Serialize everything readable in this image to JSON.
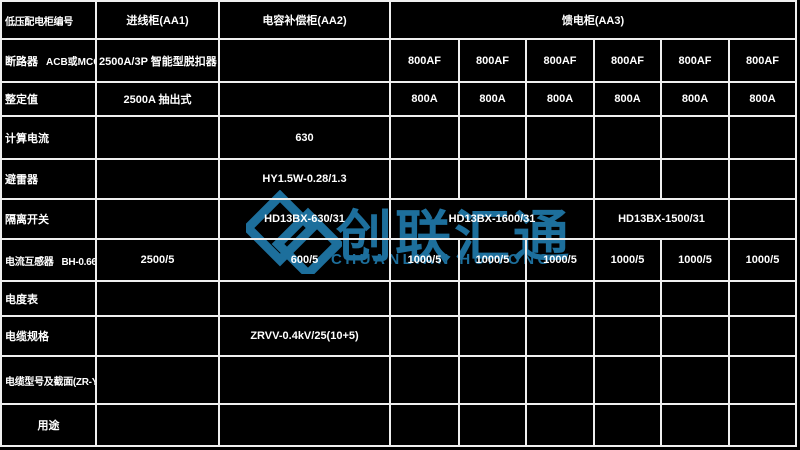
{
  "watermark": {
    "cn_text": "创联汇通",
    "en_text": "CHUANLIAN HUITONG",
    "color": "#1d6f9c"
  },
  "header": {
    "corner": "低压配电柜编号",
    "incoming": "进线柜(AA1)",
    "compensation": "电容补偿柜(AA2)",
    "feeder_section": "馈电柜(AA3)"
  },
  "rows": {
    "breaker": {
      "label": "断路器",
      "sublabel": "ACB或MCCB",
      "incoming": "2500A/3P 智能型脱扣器",
      "feeders": [
        "800AF",
        "800AF",
        "800AF",
        "800AF",
        "800AF",
        "800AF"
      ]
    },
    "setting": {
      "label": "整定值",
      "incoming": "2500A 抽出式",
      "feeders": [
        "800A",
        "800A",
        "800A",
        "800A",
        "800A",
        "800A"
      ]
    },
    "calc_current": {
      "label": "计算电流",
      "compensation": "630"
    },
    "arrester": {
      "label": "避雷器",
      "compensation": "HY1.5W-0.28/1.3"
    },
    "isolator": {
      "label": "隔离开关",
      "compensation": "HD13BX-630/31",
      "feeder_group1": "HD13BX-1600/31",
      "feeder_group2": "HD13BX-1500/31"
    },
    "ct": {
      "label": "电流互感器",
      "model": "BH-0.66",
      "incoming": "2500/5",
      "compensation": "600/5",
      "feeders": [
        "1000/5",
        "1000/5",
        "1000/5",
        "1000/5",
        "1000/5",
        "1000/5"
      ]
    },
    "meter": {
      "label": "电度表"
    },
    "cable_spec": {
      "label": "电缆规格",
      "compensation": "ZRVV-0.4kV/25(10+5)"
    },
    "cable_model": {
      "label": "电缆型号及截面(ZR-YJV22)"
    },
    "purpose": {
      "label": "用途"
    }
  }
}
